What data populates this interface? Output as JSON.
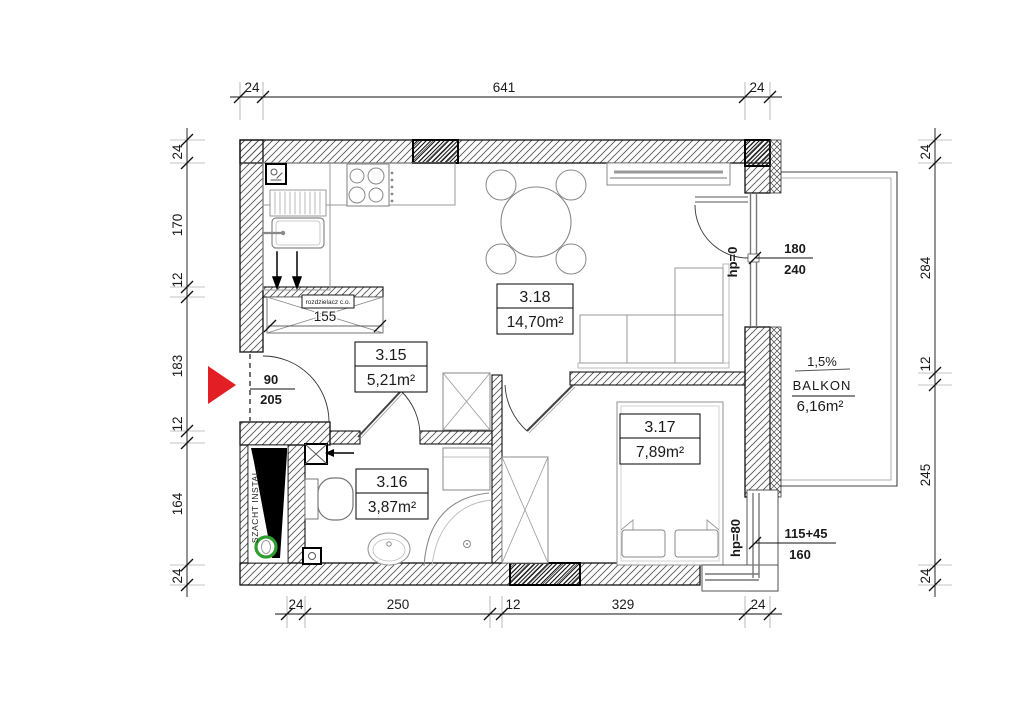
{
  "plan": {
    "rooms": [
      {
        "id": "3.15",
        "area": "5,21m²"
      },
      {
        "id": "3.16",
        "area": "3,87m²"
      },
      {
        "id": "3.17",
        "area": "7,89m²"
      },
      {
        "id": "3.18",
        "area": "14,70m²"
      }
    ],
    "balcony": {
      "slope": "1,5%",
      "name": "BALKON",
      "area": "6,16m²"
    },
    "labels": {
      "shaft": "SZACHT INSTAL.",
      "distributor": "rozdzielacz c.o.",
      "distributor_width": "155"
    },
    "openings": {
      "entrance_door": {
        "width": "90",
        "height": "205"
      },
      "balcony_door": {
        "width": "180",
        "height": "240",
        "sill": "hp=0"
      },
      "bedroom_window": {
        "width": "115+45",
        "height": "160",
        "sill": "hp=80"
      }
    },
    "dimensions": {
      "top": [
        "24",
        "641",
        "24"
      ],
      "left": [
        "24",
        "170",
        "12",
        "183",
        "12",
        "164",
        "24"
      ],
      "right": [
        "24",
        "284",
        "12",
        "245",
        "24"
      ],
      "bottom": [
        "24",
        "250",
        "12",
        "329",
        "24"
      ]
    },
    "colors": {
      "entrance_arrow": "#e31e24",
      "shaft_marker": "#2f9e2f"
    }
  }
}
